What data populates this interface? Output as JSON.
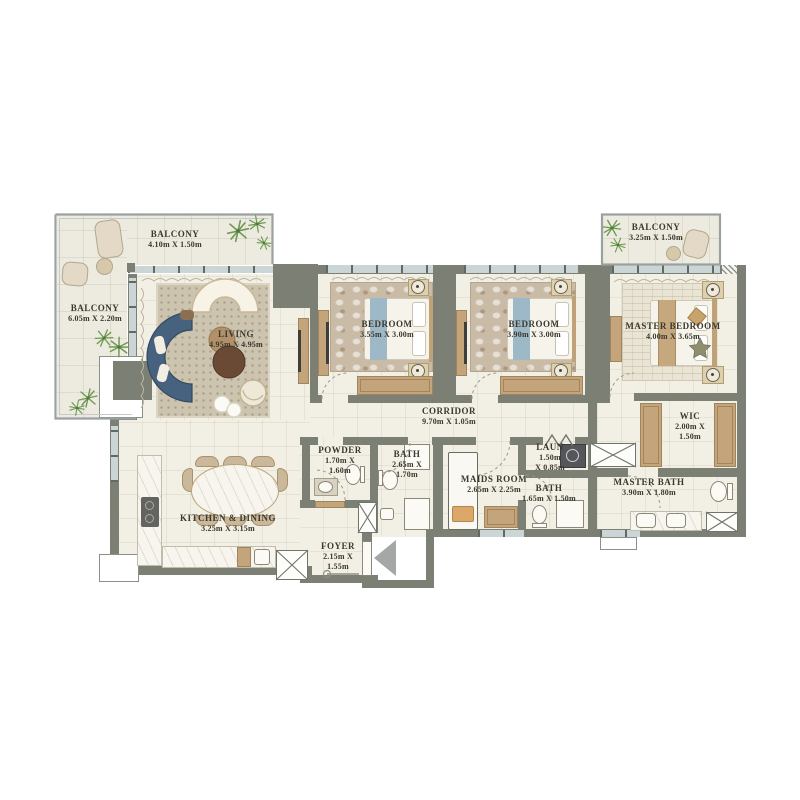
{
  "plan_type": "apartment-floor-plan",
  "rooms": [
    {
      "name": "balcony-top",
      "lines": [
        "BALCONY",
        "4.10m X 1.50m"
      ]
    },
    {
      "name": "balcony-side",
      "lines": [
        "BALCONY",
        "6.05m X 2.20m"
      ]
    },
    {
      "name": "balcony-master",
      "lines": [
        "BALCONY",
        "3.25m X 1.50m"
      ]
    },
    {
      "name": "living",
      "lines": [
        "LIVING",
        "4.95m X 4.95m"
      ]
    },
    {
      "name": "bedroom-1",
      "lines": [
        "BEDROOM",
        "3.55m X 3.00m"
      ]
    },
    {
      "name": "bedroom-2",
      "lines": [
        "BEDROOM",
        "3.90m X 3.00m"
      ]
    },
    {
      "name": "master-bedroom",
      "lines": [
        "MASTER BEDROOM",
        "4.00m X 3.65m"
      ]
    },
    {
      "name": "corridor",
      "lines": [
        "CORRIDOR",
        "9.70m X 1.05m"
      ]
    },
    {
      "name": "wic",
      "lines": [
        "WIC",
        "2.00m X",
        "1.50m"
      ]
    },
    {
      "name": "powder",
      "lines": [
        "POWDER",
        "1.70m X",
        "1.60m"
      ]
    },
    {
      "name": "bath-1",
      "lines": [
        "BATH",
        "2.65m X",
        "1.70m"
      ]
    },
    {
      "name": "maids-room",
      "lines": [
        "MAIDS ROOM",
        "2.65m X 2.25m"
      ]
    },
    {
      "name": "laundry",
      "lines": [
        "LAUN",
        "1.50m",
        "X 0.85m"
      ]
    },
    {
      "name": "bath-2",
      "lines": [
        "BATH",
        "1.65m X 1.50m"
      ]
    },
    {
      "name": "master-bath",
      "lines": [
        "MASTER BATH",
        "3.90m X 1.80m"
      ]
    },
    {
      "name": "kitchen-dining",
      "lines": [
        "KITCHEN & DINING",
        "3.25m X 3.15m"
      ]
    },
    {
      "name": "foyer",
      "lines": [
        "FOYER",
        "2.15m X",
        "1.55m"
      ]
    }
  ],
  "icons": {
    "entry_arrow": "triangle-left",
    "shaft": "x-crossed-box",
    "plant": "starburst-foliage",
    "door_swing": "dashed-quarter-arc"
  },
  "colors": {
    "wall": "#7b7f74",
    "floor": "#f2efe4",
    "balcony_floor": "#edebdf",
    "wood": "#c3a47b",
    "sofa_blue": "#46627f",
    "throw_blue": "#9db8c6",
    "window_glass": "#ccd5d6",
    "plant_green": "#6f9a55",
    "label_text": "#3b392f",
    "entry_arrow_gray": "#a3a7a5"
  }
}
